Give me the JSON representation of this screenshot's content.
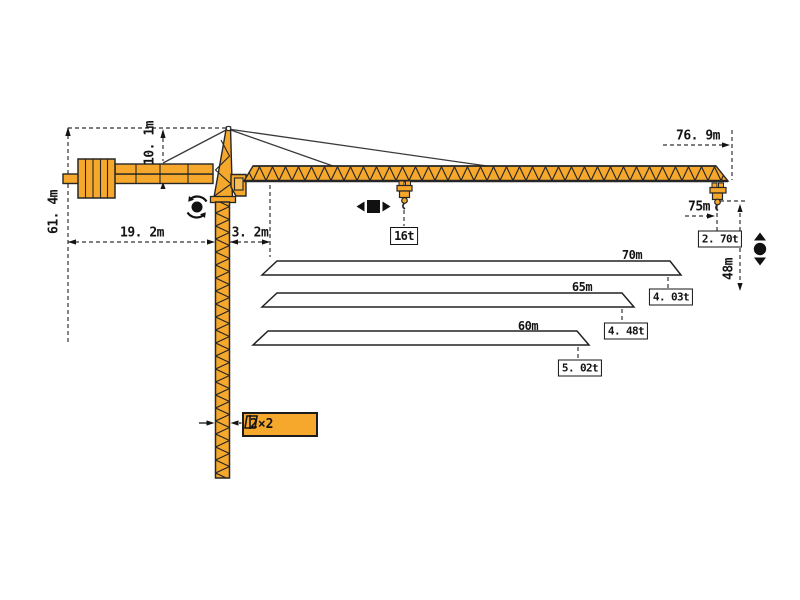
{
  "diagram": {
    "type": "tower-crane-specification-drawing",
    "colors": {
      "crane_fill": "#F6A82C",
      "outline": "#262626",
      "dim_line": "#333333",
      "background": "#FFFFFF"
    },
    "dimensions": {
      "total_height": "61. 4m",
      "tower_head_height": "10. 1m",
      "counter_jib_radius": "19. 2m",
      "mast_to_jib_offset": "3. 2m",
      "max_working_radius": "76. 9m",
      "tip_radius": "75m",
      "hook_height_under_jib": "48m"
    },
    "loads": {
      "max_load": "16t",
      "tip_load_75m": "2. 70t"
    },
    "jib_options": [
      {
        "jib_length": "70m",
        "tip_load": "4. 03t"
      },
      {
        "jib_length": "65m",
        "tip_load": "4. 48t"
      },
      {
        "jib_length": "60m",
        "tip_load": "5. 02t"
      }
    ],
    "mast_section": "2×2",
    "icons": [
      "slewing-icon",
      "trolley-travel-icon",
      "hoisting-icon",
      "mast-section-icon"
    ]
  }
}
